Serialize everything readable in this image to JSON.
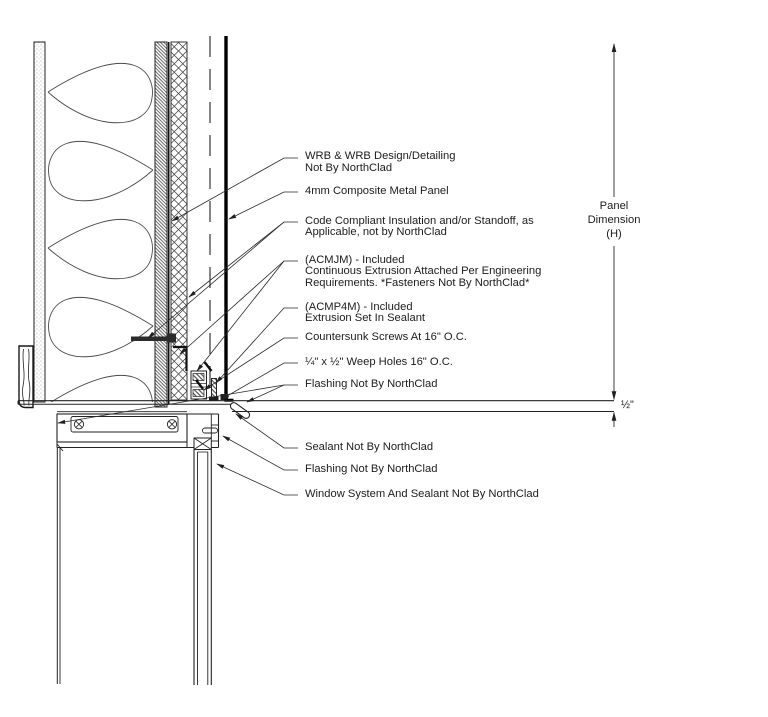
{
  "callouts": [
    {
      "id": "wrb",
      "lines": [
        "WRB & WRB Design/Detailing",
        "Not By NorthClad"
      ]
    },
    {
      "id": "composite-panel",
      "lines": [
        "4mm Composite Metal Panel"
      ]
    },
    {
      "id": "insulation",
      "lines": [
        "Code Compliant Insulation and/or Standoff, as",
        "Applicable, not by NorthClad"
      ]
    },
    {
      "id": "acmjm",
      "lines": [
        "(ACMJM) - Included",
        "Continuous Extrusion Attached Per Engineering",
        "Requirements. *Fasteners Not By NorthClad*"
      ]
    },
    {
      "id": "acmp4m",
      "lines": [
        "(ACMP4M) - Included",
        "Extrusion Set In Sealant"
      ]
    },
    {
      "id": "countersunk-screws",
      "lines": [
        "Countersunk Screws At 16\" O.C."
      ]
    },
    {
      "id": "weep-holes",
      "lines": [
        "¼\" x ½\" Weep Holes 16\" O.C."
      ]
    },
    {
      "id": "flashing-upper",
      "lines": [
        "Flashing Not By NorthClad"
      ]
    },
    {
      "id": "sealant",
      "lines": [
        "Sealant Not By NorthClad"
      ]
    },
    {
      "id": "flashing-lower",
      "lines": [
        "Flashing Not By NorthClad"
      ]
    },
    {
      "id": "window-system",
      "lines": [
        "Window System And Sealant Not By NorthClad"
      ]
    }
  ],
  "dimensions": {
    "panel_dimension": {
      "lines": [
        "Panel",
        "Dimension",
        "(H)"
      ]
    },
    "gap": "½\""
  },
  "colors": {
    "line": "#222222",
    "text": "#1c1c1c",
    "background": "#ffffff"
  }
}
